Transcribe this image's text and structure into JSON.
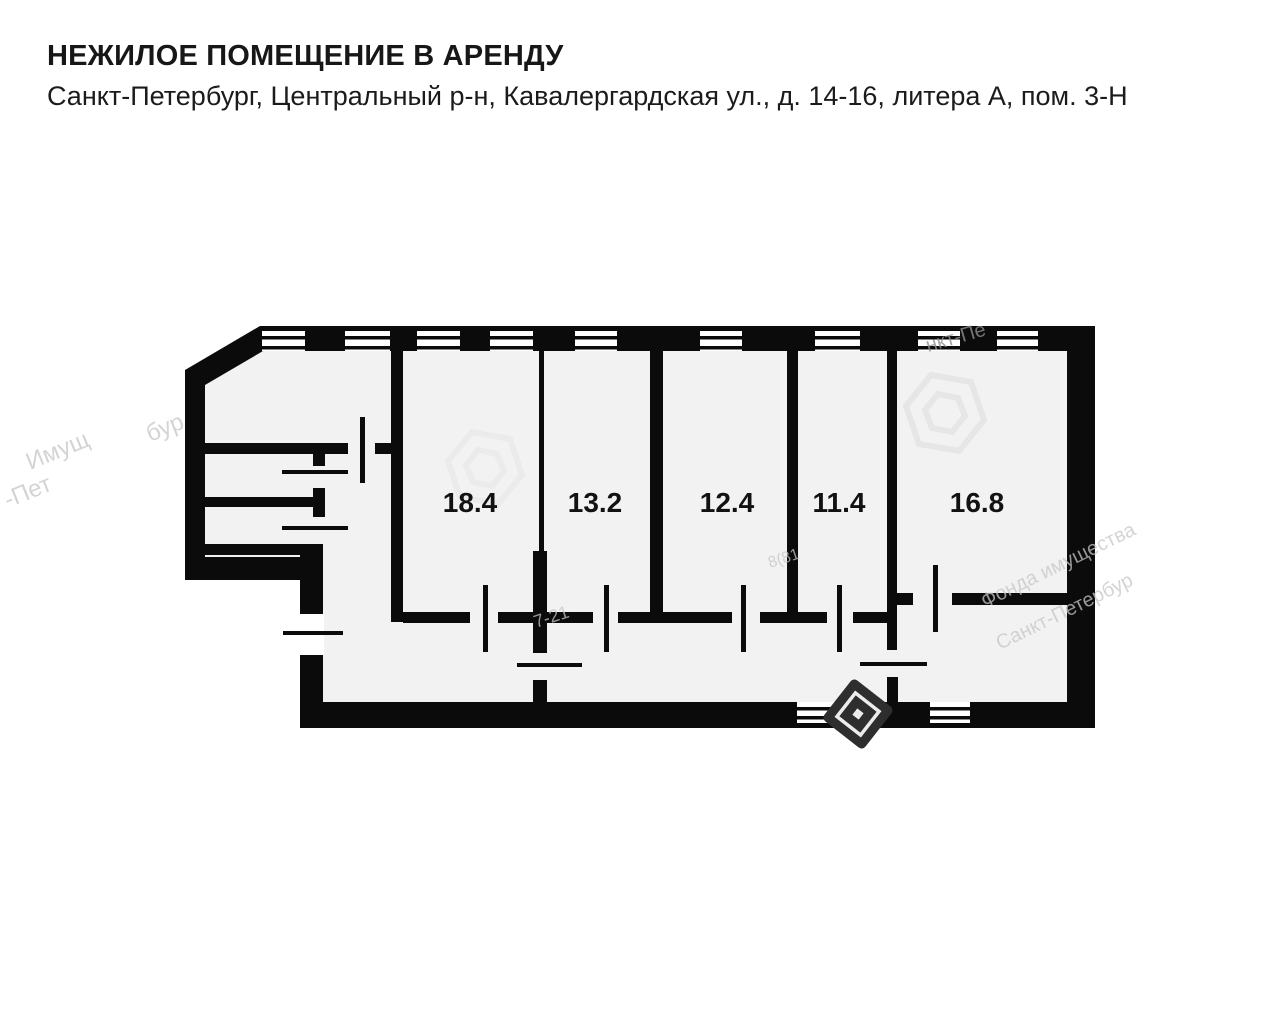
{
  "header": {
    "title": "НЕЖИЛОЕ ПОМЕЩЕНИЕ В АРЕНДУ",
    "address": "Санкт-Петербург, Центральный р-н, Кавалергардская ул., д. 14-16, литера А, пом. 3-Н"
  },
  "floor_plan": {
    "type": "apartment-floor-plan",
    "rooms": [
      {
        "id": "room-1",
        "area": "18.4"
      },
      {
        "id": "room-2",
        "area": "13.2"
      },
      {
        "id": "room-3",
        "area": "12.4"
      },
      {
        "id": "room-4",
        "area": "11.4"
      },
      {
        "id": "room-5",
        "area": "16.8"
      }
    ],
    "colors": {
      "wall": "#0b0b0b",
      "floor": "#f2f2f2",
      "page_background": "#ffffff",
      "watermark_light": "#c6c6c6",
      "stamp_dark": "#2e2e2e"
    },
    "watermarks": {
      "left_1": "Имущ",
      "left_2": "бур",
      "left_3": "-Пет",
      "top_right": "нкт-Пе",
      "right_1": "Фонда имущества",
      "right_2": "Санкт-Петербур",
      "center_1": "7-21",
      "center_2": "8(81"
    }
  }
}
